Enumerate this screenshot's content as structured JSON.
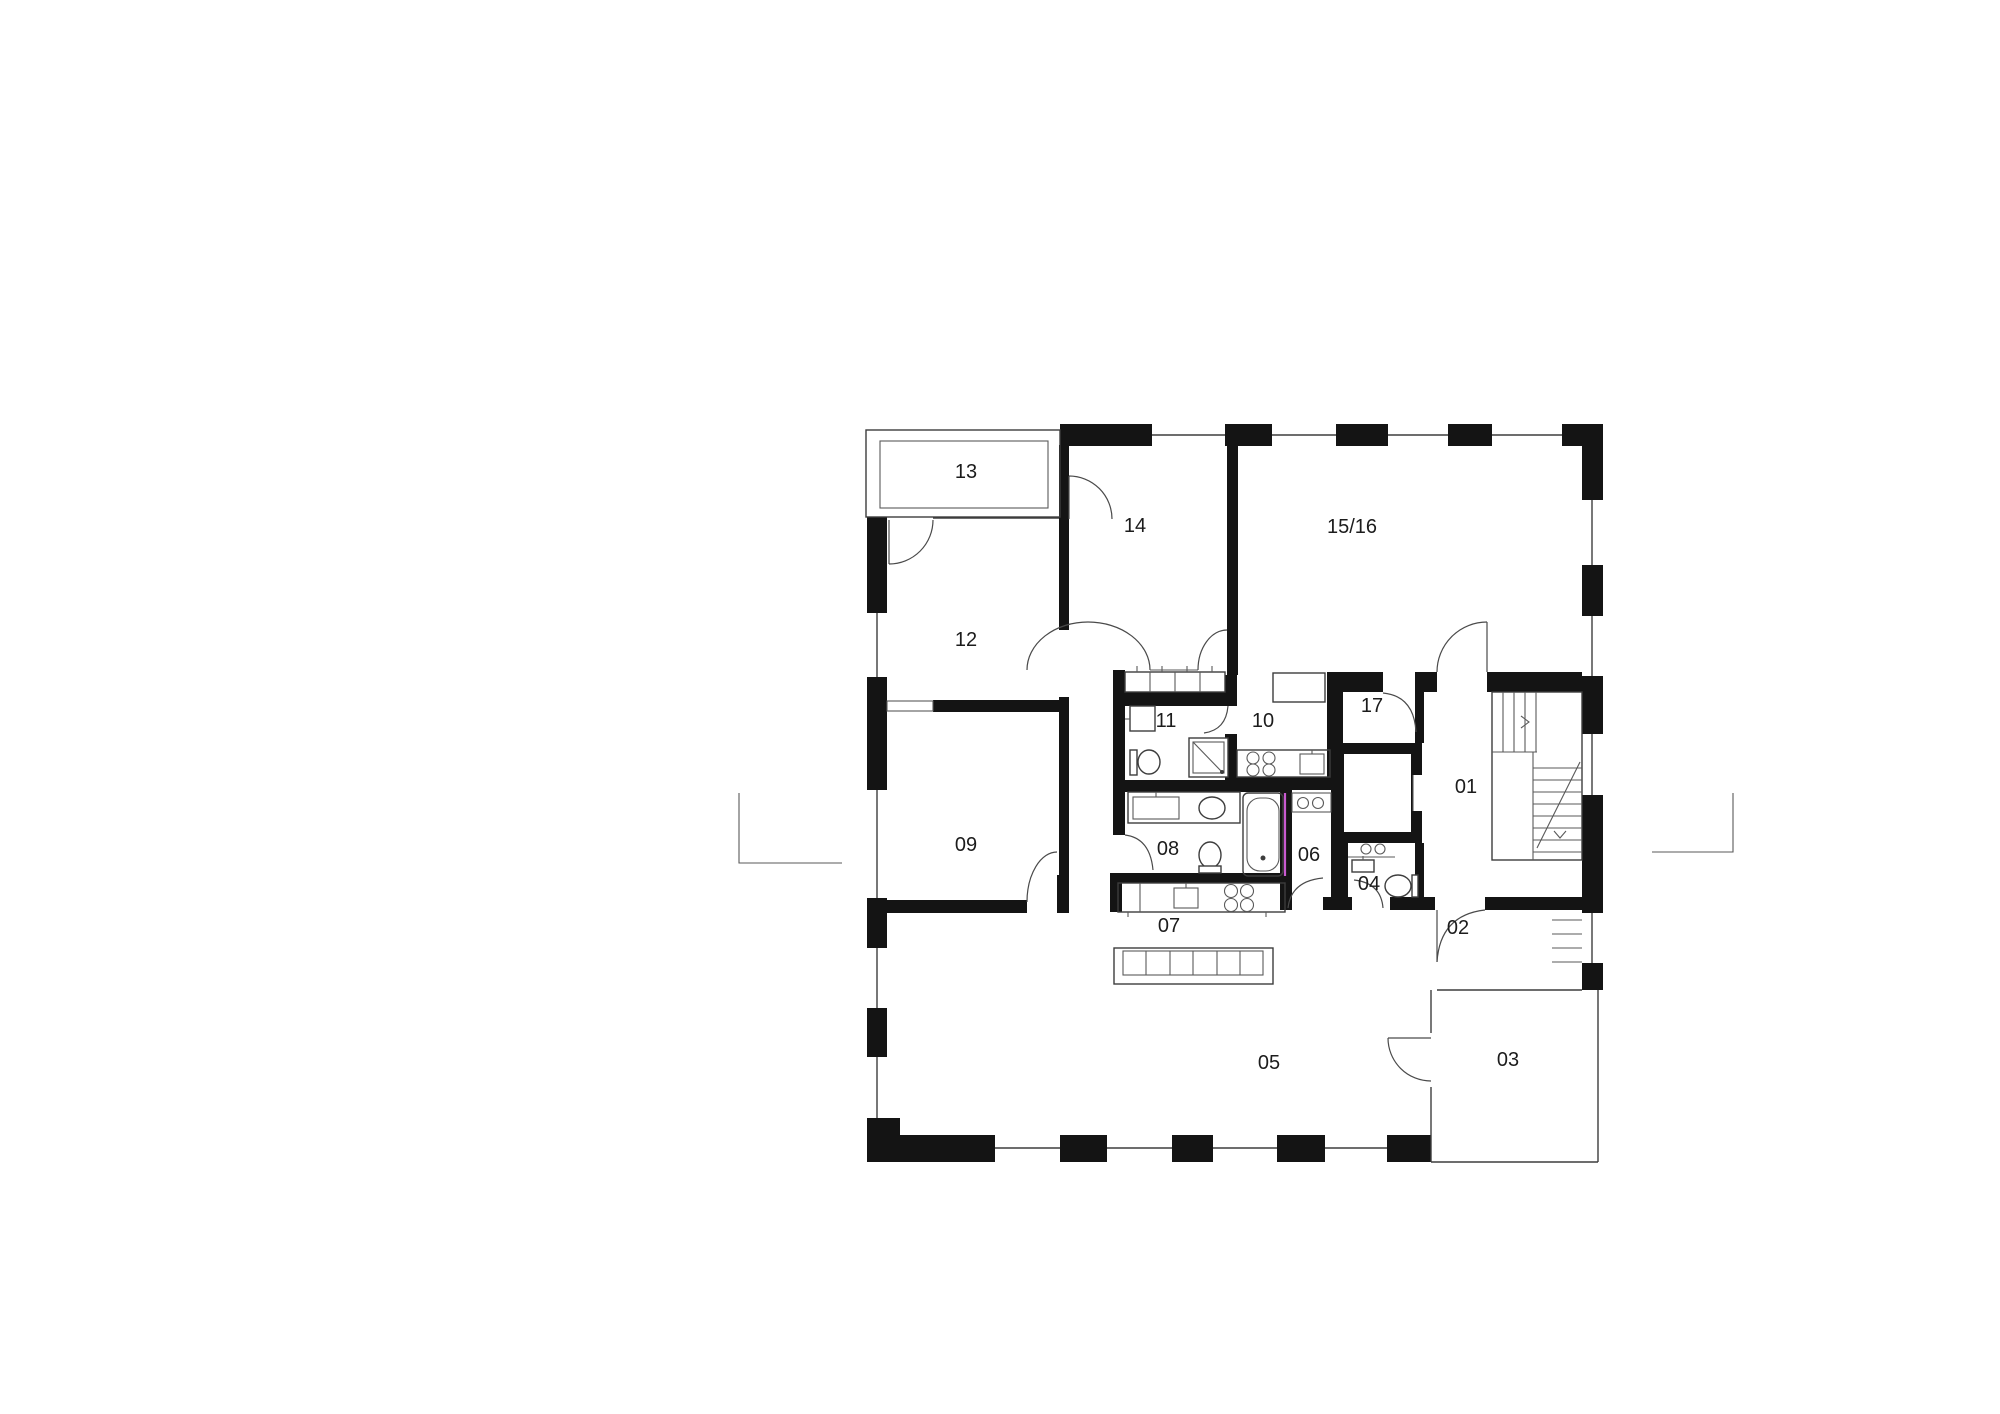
{
  "plan": {
    "type": "architectural-floor-plan",
    "background_color": "#ffffff",
    "wall_color": "#141414",
    "line_color": "#3d3d3d",
    "accent_color": "#c95ad0",
    "rooms": [
      {
        "id": "01",
        "label": "01"
      },
      {
        "id": "02",
        "label": "02"
      },
      {
        "id": "03",
        "label": "03"
      },
      {
        "id": "04",
        "label": "04"
      },
      {
        "id": "05",
        "label": "05"
      },
      {
        "id": "06",
        "label": "06"
      },
      {
        "id": "07",
        "label": "07"
      },
      {
        "id": "08",
        "label": "08"
      },
      {
        "id": "09",
        "label": "09"
      },
      {
        "id": "10",
        "label": "10"
      },
      {
        "id": "11",
        "label": "11"
      },
      {
        "id": "12",
        "label": "12"
      },
      {
        "id": "13",
        "label": "13"
      },
      {
        "id": "14",
        "label": "14"
      },
      {
        "id": "15/16",
        "label": "15/16"
      },
      {
        "id": "17",
        "label": "17"
      }
    ]
  }
}
